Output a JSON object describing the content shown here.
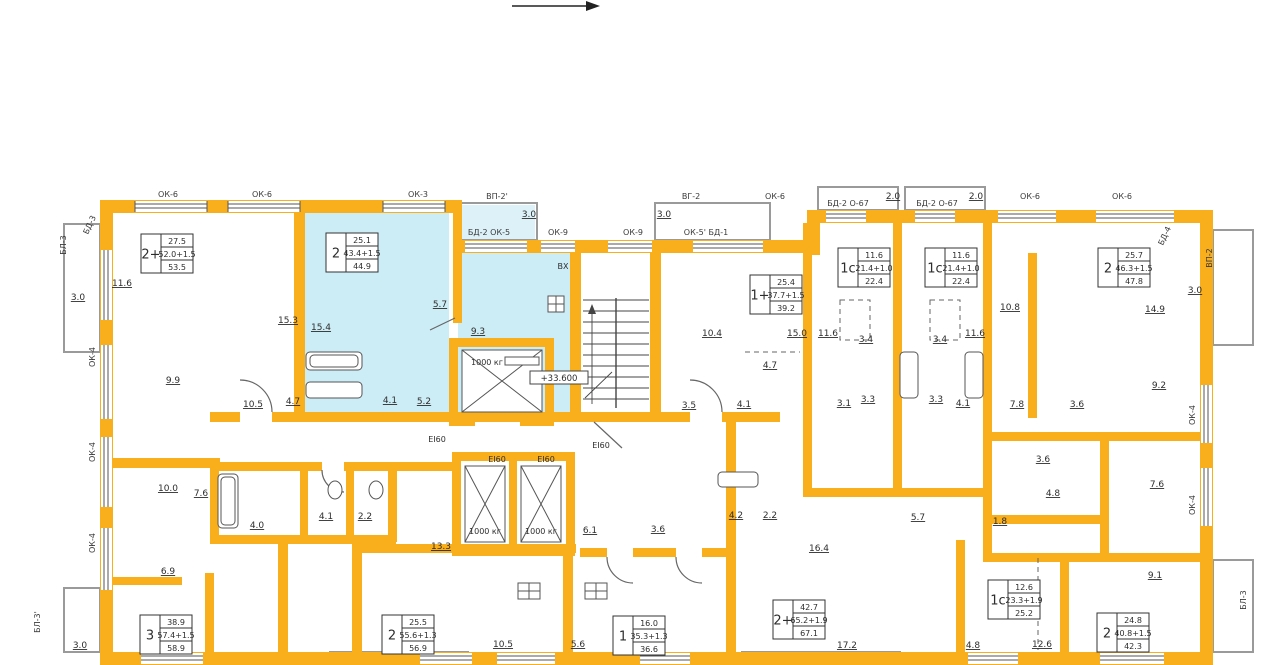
{
  "plan": {
    "level_mark": "+33.600",
    "wall_color": "#F9AE1B",
    "highlight_color": "#CDEDF6",
    "highlighted_apartment": {
      "type": "2",
      "living": "25.1",
      "formula": "43.4+1.5",
      "total": "44.9"
    }
  },
  "apartments": [
    {
      "type": "2+",
      "living": "27.5",
      "formula": "52.0+1.5",
      "total": "53.5",
      "x": 141,
      "y": 234,
      "highlighted": false
    },
    {
      "type": "2",
      "living": "25.1",
      "formula": "43.4+1.5",
      "total": "44.9",
      "x": 326,
      "y": 233,
      "highlighted": true
    },
    {
      "type": "1+",
      "living": "25.4",
      "formula": "37.7+1.5",
      "total": "39.2",
      "x": 750,
      "y": 275,
      "highlighted": false
    },
    {
      "type": "1с",
      "living": "11.6",
      "formula": "21.4+1.0",
      "total": "22.4",
      "x": 838,
      "y": 248,
      "highlighted": false
    },
    {
      "type": "1с",
      "living": "11.6",
      "formula": "21.4+1.0",
      "total": "22.4",
      "x": 925,
      "y": 248,
      "highlighted": false
    },
    {
      "type": "2",
      "living": "25.7",
      "formula": "46.3+1.5",
      "total": "47.8",
      "x": 1098,
      "y": 248,
      "highlighted": false
    },
    {
      "type": "3",
      "living": "38.9",
      "formula": "57.4+1.5",
      "total": "58.9",
      "x": 140,
      "y": 615,
      "highlighted": false
    },
    {
      "type": "2",
      "living": "25.5",
      "formula": "55.6+1.3",
      "total": "56.9",
      "x": 382,
      "y": 615,
      "highlighted": false
    },
    {
      "type": "1",
      "living": "16.0",
      "formula": "35.3+1.3",
      "total": "36.6",
      "x": 613,
      "y": 616,
      "highlighted": false
    },
    {
      "type": "2+",
      "living": "42.7",
      "formula": "65.2+1.9",
      "total": "67.1",
      "x": 773,
      "y": 600,
      "highlighted": false
    },
    {
      "type": "1с",
      "living": "12.6",
      "formula": "23.3+1.9",
      "total": "25.2",
      "x": 988,
      "y": 580,
      "highlighted": false
    },
    {
      "type": "2",
      "living": "24.8",
      "formula": "40.8+1.5",
      "total": "42.3",
      "x": 1097,
      "y": 613,
      "highlighted": false
    }
  ],
  "room_labels": [
    {
      "v": "11.6",
      "x": 122,
      "y": 286
    },
    {
      "v": "15.3",
      "x": 288,
      "y": 323
    },
    {
      "v": "15.4",
      "x": 321,
      "y": 330
    },
    {
      "v": "9.9",
      "x": 173,
      "y": 383
    },
    {
      "v": "10.5",
      "x": 253,
      "y": 407
    },
    {
      "v": "4.7",
      "x": 293,
      "y": 404
    },
    {
      "v": "4.1",
      "x": 390,
      "y": 403
    },
    {
      "v": "5.2",
      "x": 424,
      "y": 404
    },
    {
      "v": "5.7",
      "x": 440,
      "y": 307
    },
    {
      "v": "9.3",
      "x": 478,
      "y": 334
    },
    {
      "v": "3.0",
      "x": 78,
      "y": 300
    },
    {
      "v": "3.0",
      "x": 529,
      "y": 217
    },
    {
      "v": "3.0",
      "x": 664,
      "y": 217
    },
    {
      "v": "2.0",
      "x": 893,
      "y": 199
    },
    {
      "v": "2.0",
      "x": 976,
      "y": 199
    },
    {
      "v": "3.0",
      "x": 1195,
      "y": 293
    },
    {
      "v": "10.4",
      "x": 712,
      "y": 336
    },
    {
      "v": "15.0",
      "x": 797,
      "y": 336
    },
    {
      "v": "11.6",
      "x": 828,
      "y": 336
    },
    {
      "v": "11.6",
      "x": 975,
      "y": 336
    },
    {
      "v": "10.8",
      "x": 1010,
      "y": 310
    },
    {
      "v": "14.9",
      "x": 1155,
      "y": 312
    },
    {
      "v": "4.7",
      "x": 770,
      "y": 368
    },
    {
      "v": "3.5",
      "x": 689,
      "y": 408
    },
    {
      "v": "4.1",
      "x": 744,
      "y": 407
    },
    {
      "v": "3.1",
      "x": 844,
      "y": 406
    },
    {
      "v": "3.3",
      "x": 868,
      "y": 402
    },
    {
      "v": "3.4",
      "x": 866,
      "y": 342
    },
    {
      "v": "3.4",
      "x": 940,
      "y": 342
    },
    {
      "v": "3.3",
      "x": 936,
      "y": 402
    },
    {
      "v": "4.1",
      "x": 963,
      "y": 406
    },
    {
      "v": "7.8",
      "x": 1017,
      "y": 407
    },
    {
      "v": "3.6",
      "x": 1077,
      "y": 407
    },
    {
      "v": "9.2",
      "x": 1159,
      "y": 388
    },
    {
      "v": "3.6",
      "x": 1043,
      "y": 462
    },
    {
      "v": "4.8",
      "x": 1053,
      "y": 496
    },
    {
      "v": "7.6",
      "x": 1157,
      "y": 487
    },
    {
      "v": "1.8",
      "x": 1000,
      "y": 524
    },
    {
      "v": "10.0",
      "x": 168,
      "y": 491
    },
    {
      "v": "7.6",
      "x": 201,
      "y": 496
    },
    {
      "v": "4.0",
      "x": 257,
      "y": 528
    },
    {
      "v": "4.1",
      "x": 326,
      "y": 519
    },
    {
      "v": "2.2",
      "x": 365,
      "y": 519
    },
    {
      "v": "13.3",
      "x": 441,
      "y": 549
    },
    {
      "v": "6.9",
      "x": 168,
      "y": 574
    },
    {
      "v": "10.5",
      "x": 503,
      "y": 647
    },
    {
      "v": "5.6",
      "x": 578,
      "y": 647
    },
    {
      "v": "6.1",
      "x": 590,
      "y": 533
    },
    {
      "v": "3.6",
      "x": 658,
      "y": 532
    },
    {
      "v": "4.2",
      "x": 736,
      "y": 518
    },
    {
      "v": "2.2",
      "x": 770,
      "y": 518
    },
    {
      "v": "16.4",
      "x": 819,
      "y": 551
    },
    {
      "v": "17.2",
      "x": 847,
      "y": 648
    },
    {
      "v": "4.8",
      "x": 973,
      "y": 648
    },
    {
      "v": "12.6",
      "x": 1042,
      "y": 647
    },
    {
      "v": "5.7",
      "x": 918,
      "y": 520
    },
    {
      "v": "9.1",
      "x": 1155,
      "y": 578
    },
    {
      "v": "3.0",
      "x": 80,
      "y": 648
    }
  ],
  "mark_labels": [
    {
      "v": "ОК-6",
      "x": 168,
      "y": 197
    },
    {
      "v": "ОК-6",
      "x": 262,
      "y": 197
    },
    {
      "v": "ОК-3",
      "x": 418,
      "y": 197
    },
    {
      "v": "ВП-2'",
      "x": 497,
      "y": 199
    },
    {
      "v": "БД-2 ОК-5",
      "x": 489,
      "y": 235
    },
    {
      "v": "ОК-9",
      "x": 558,
      "y": 235
    },
    {
      "v": "ОК-9",
      "x": 633,
      "y": 235
    },
    {
      "v": "ВГ-2",
      "x": 691,
      "y": 199
    },
    {
      "v": "ОК-5' БД-1",
      "x": 706,
      "y": 235
    },
    {
      "v": "ОК-6",
      "x": 775,
      "y": 199
    },
    {
      "v": "БД-2 О-67",
      "x": 848,
      "y": 206
    },
    {
      "v": "БД-2 О-67",
      "x": 937,
      "y": 206
    },
    {
      "v": "ОК-6",
      "x": 1030,
      "y": 199
    },
    {
      "v": "ОК-6",
      "x": 1122,
      "y": 199
    },
    {
      "v": "БЛ-3",
      "x": 66,
      "y": 245,
      "rot": -90
    },
    {
      "v": "БД-3",
      "x": 92,
      "y": 226,
      "rot": -65
    },
    {
      "v": "ОК-4",
      "x": 95,
      "y": 357,
      "rot": -90
    },
    {
      "v": "ОК-4",
      "x": 95,
      "y": 452,
      "rot": -90
    },
    {
      "v": "ОК-4",
      "x": 95,
      "y": 543,
      "rot": -90
    },
    {
      "v": "БД-4",
      "x": 1167,
      "y": 237,
      "rot": -65
    },
    {
      "v": "ВП-2",
      "x": 1212,
      "y": 258,
      "rot": -90
    },
    {
      "v": "ОК-4",
      "x": 1195,
      "y": 415,
      "rot": -90
    },
    {
      "v": "ОК-4",
      "x": 1195,
      "y": 505,
      "rot": -90
    },
    {
      "v": "БЛ-3'",
      "x": 40,
      "y": 622,
      "rot": -90
    },
    {
      "v": "БЛ-3",
      "x": 1246,
      "y": 600,
      "rot": -90
    }
  ],
  "core_labels": [
    {
      "v": "ВХ",
      "x": 563,
      "y": 269
    },
    {
      "v": "1000 кг",
      "x": 487,
      "y": 365
    },
    {
      "v": "1000 кг",
      "x": 485,
      "y": 534
    },
    {
      "v": "1000 кг",
      "x": 541,
      "y": 534
    },
    {
      "v": "EI60",
      "x": 437,
      "y": 442
    },
    {
      "v": "EI60",
      "x": 497,
      "y": 462
    },
    {
      "v": "EI60",
      "x": 546,
      "y": 462
    },
    {
      "v": "EI60",
      "x": 601,
      "y": 448
    }
  ]
}
